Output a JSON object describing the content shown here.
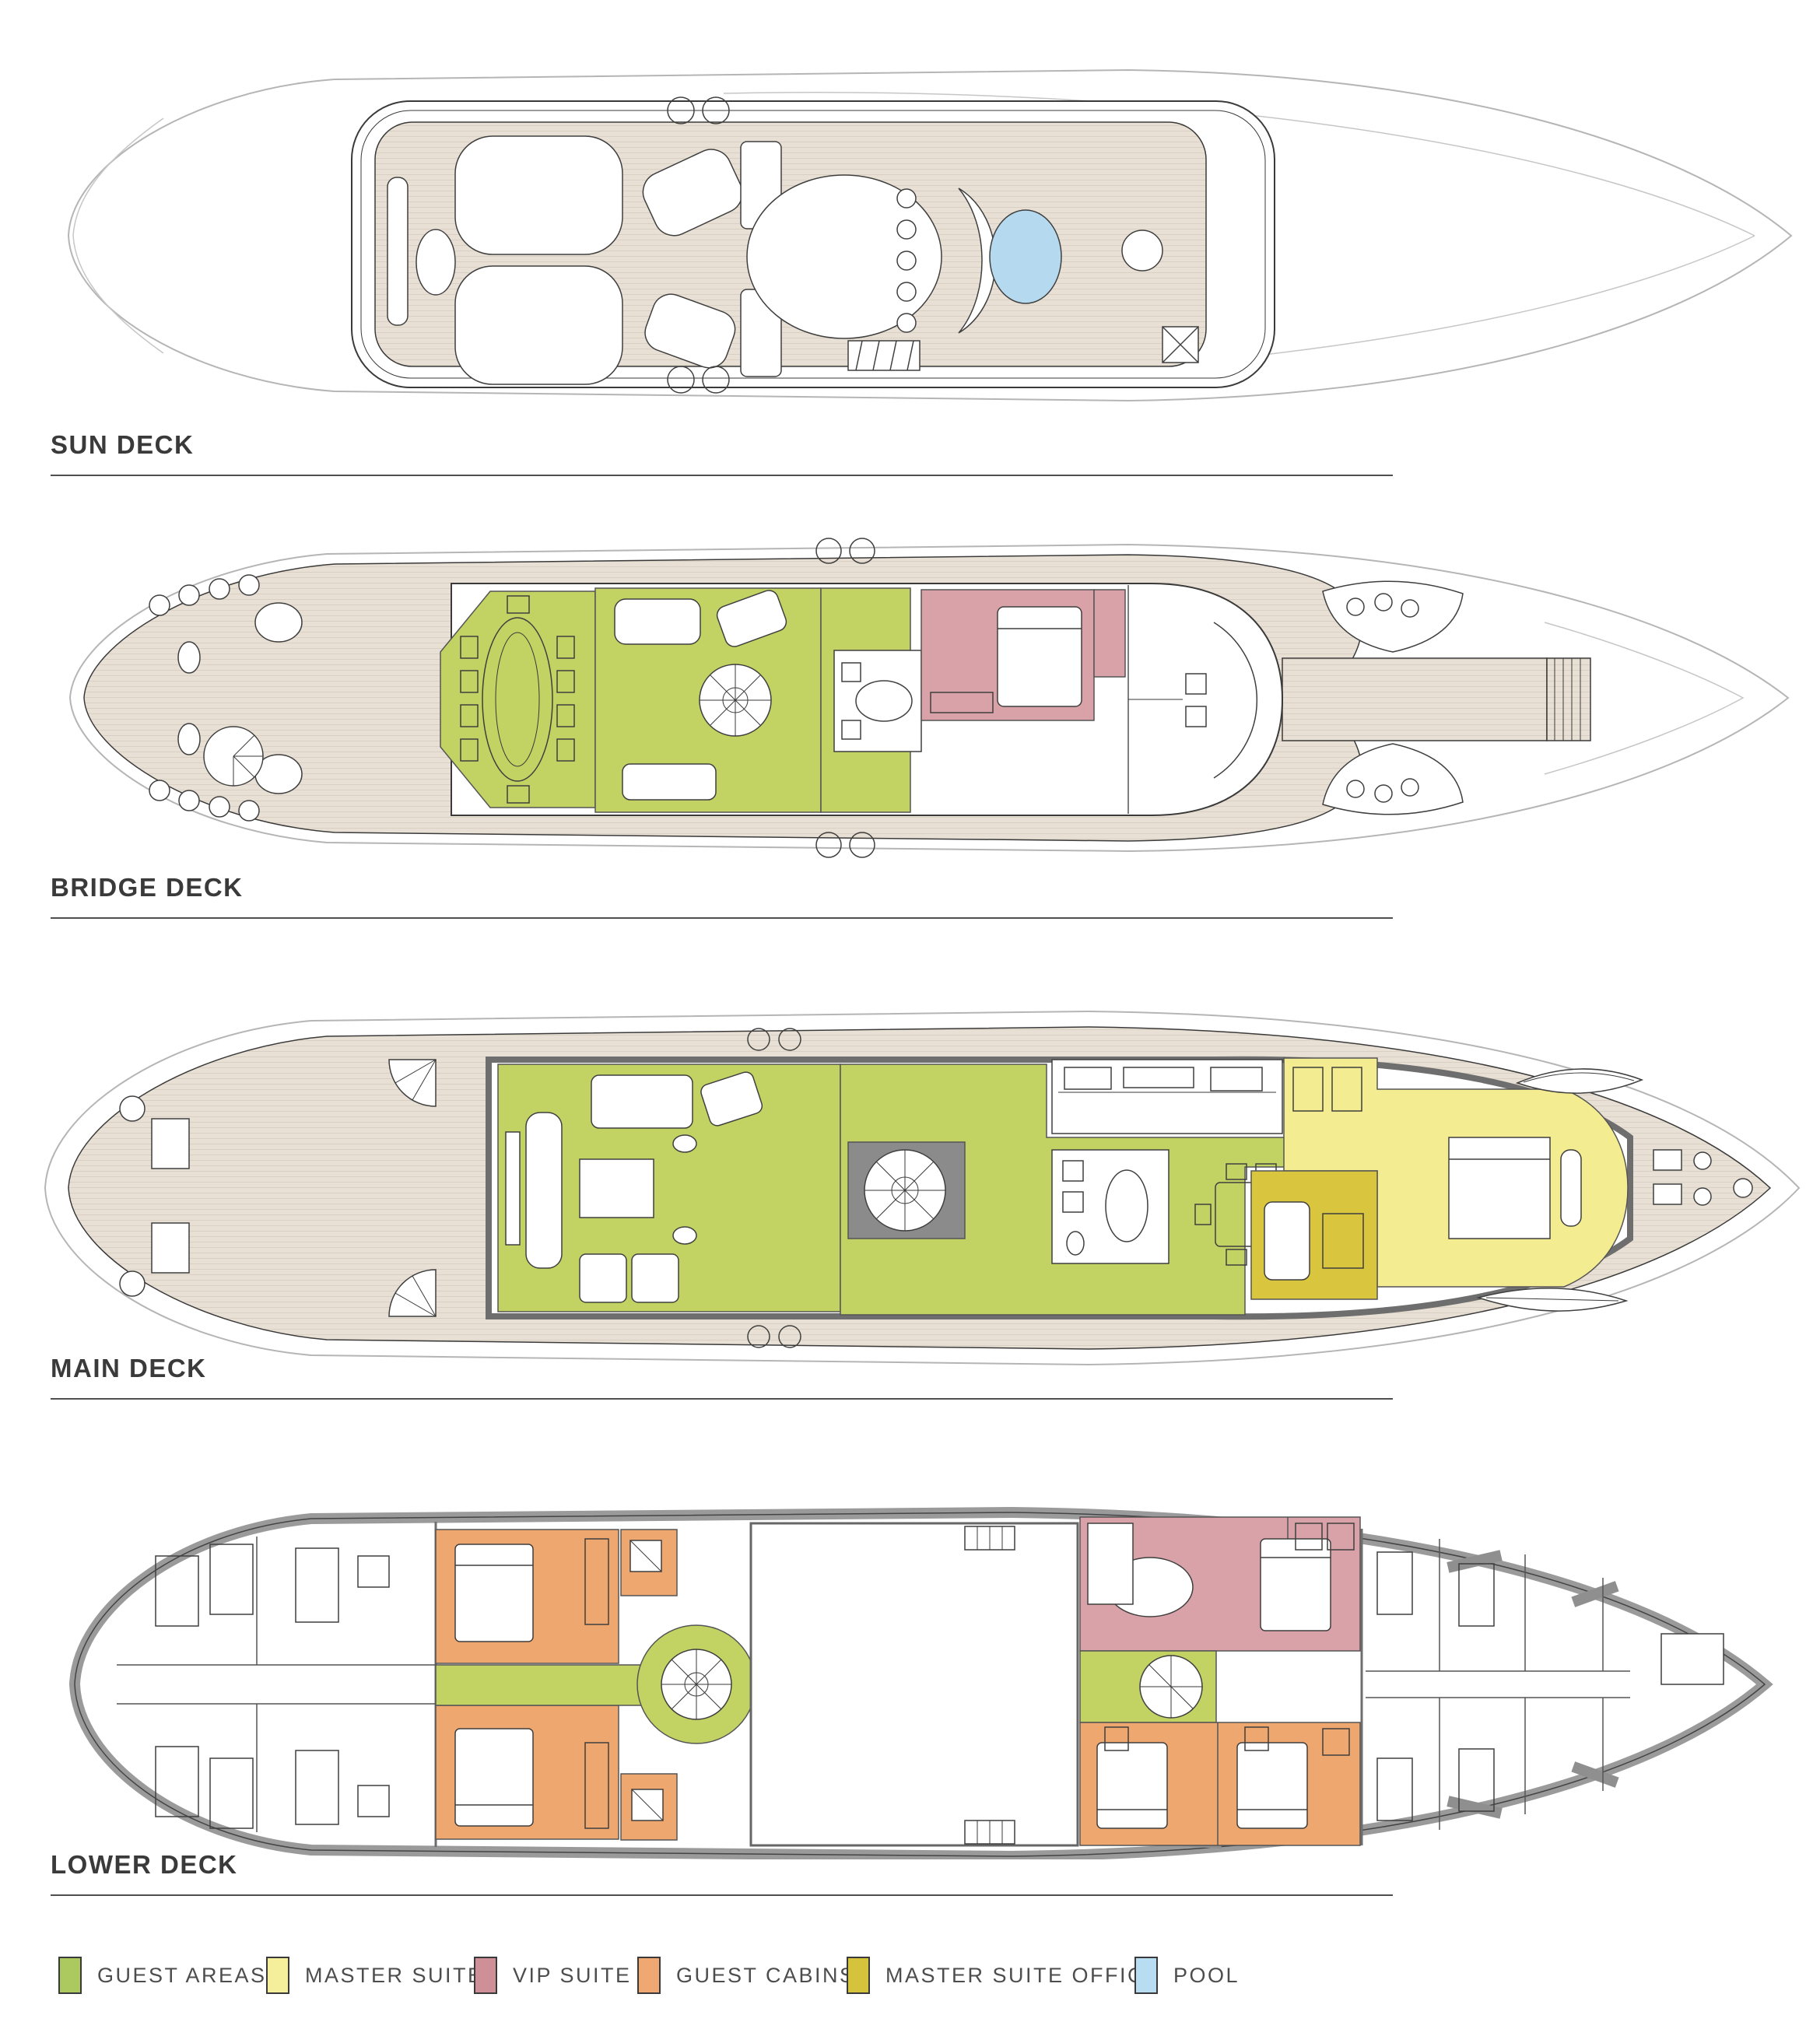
{
  "page": {
    "background": "#ffffff"
  },
  "decks": [
    {
      "id": "sun-deck",
      "label": "SUN DECK"
    },
    {
      "id": "bridge-deck",
      "label": "BRIDGE DECK"
    },
    {
      "id": "main-deck",
      "label": "MAIN DECK"
    },
    {
      "id": "lower-deck",
      "label": "LOWER DECK"
    }
  ],
  "legend": {
    "items": [
      {
        "key": "guest-areas",
        "label": "GUEST AREAS",
        "color": "#abc95e"
      },
      {
        "key": "master-suite",
        "label": "MASTER SUITE",
        "color": "#f5ee9a"
      },
      {
        "key": "vip-suite",
        "label": "VIP SUITE",
        "color": "#ce8f97"
      },
      {
        "key": "guest-cabins",
        "label": "GUEST CABINS",
        "color": "#f0a873"
      },
      {
        "key": "master-suite-office",
        "label": "MASTER SUITE OFFICE",
        "color": "#d5c33c"
      },
      {
        "key": "pool",
        "label": "POOL",
        "color": "#b8dcf2"
      }
    ]
  },
  "room_colors": {
    "guest-areas": "#c2d363",
    "master-suite": "#f4ec90",
    "vip-suite": "#d9a2a8",
    "guest-cabins": "#efa770",
    "master-suite-office": "#d9c63e",
    "pool": "#b5d9ef"
  },
  "plan_colors": {
    "deck_teak": "#e8e0d4",
    "deck_plank_line": "#d9cfc2",
    "hull_outline": "#b5b5b5",
    "wall": "#8f8f8f",
    "line": "#3f3f3f"
  }
}
